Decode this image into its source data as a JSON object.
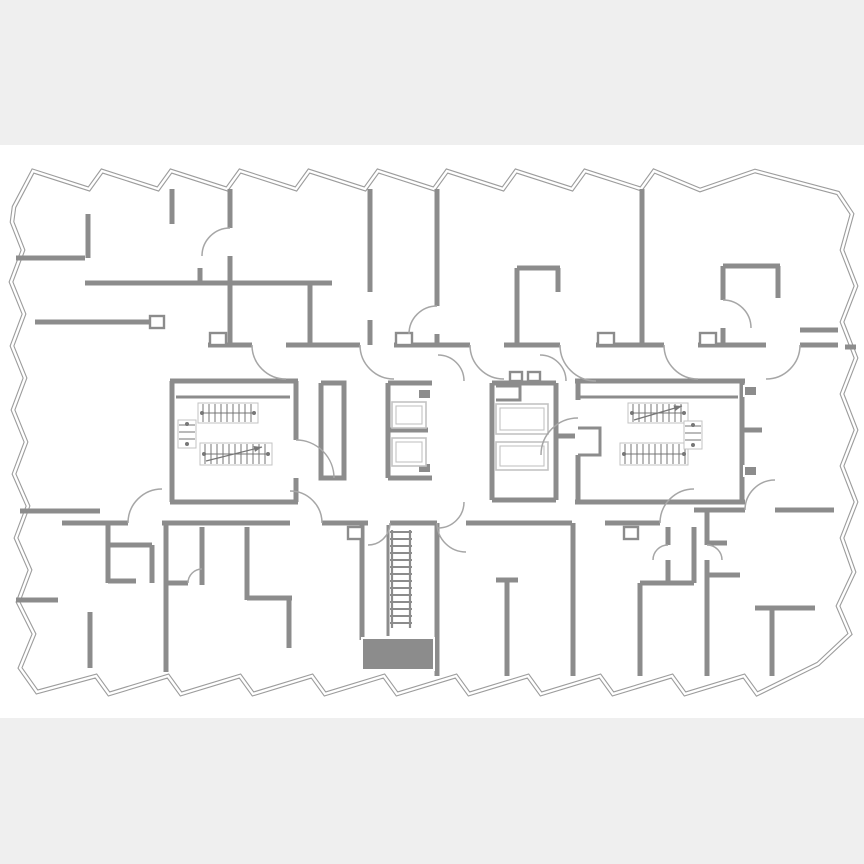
{
  "meta": {
    "kind": "architectural-floor-plan",
    "floor_text": ""
  },
  "colors": {
    "canvas_bg": "#efefef",
    "plan_bg": "#ffffff",
    "wall": "#8c8c8c",
    "outline": "#9c9c9c",
    "light": "#c3c3c3",
    "rail": "#777777",
    "arc": "#a6a6a6"
  },
  "plan": {
    "band": {
      "top": 145,
      "bottom": 718
    },
    "perimeter": [
      [
        14,
        207
      ],
      [
        33,
        171
      ],
      [
        89,
        189
      ],
      [
        102,
        171
      ],
      [
        158,
        189
      ],
      [
        171,
        171
      ],
      [
        227,
        189
      ],
      [
        240,
        171
      ],
      [
        296,
        189
      ],
      [
        309,
        171
      ],
      [
        365,
        189
      ],
      [
        378,
        171
      ],
      [
        434,
        189
      ],
      [
        447,
        171
      ],
      [
        503,
        189
      ],
      [
        516,
        171
      ],
      [
        572,
        189
      ],
      [
        585,
        171
      ],
      [
        641,
        189
      ],
      [
        654,
        171
      ],
      [
        700,
        190
      ],
      [
        755,
        171
      ],
      [
        838,
        193
      ],
      [
        852,
        214
      ],
      [
        842,
        250
      ],
      [
        856,
        286
      ],
      [
        842,
        322
      ],
      [
        856,
        358
      ],
      [
        842,
        394
      ],
      [
        856,
        430
      ],
      [
        842,
        466
      ],
      [
        856,
        502
      ],
      [
        842,
        538
      ],
      [
        854,
        572
      ],
      [
        838,
        606
      ],
      [
        850,
        634
      ],
      [
        818,
        664
      ],
      [
        757,
        694
      ],
      [
        744,
        676
      ],
      [
        685,
        694
      ],
      [
        672,
        676
      ],
      [
        613,
        694
      ],
      [
        600,
        676
      ],
      [
        541,
        694
      ],
      [
        528,
        676
      ],
      [
        469,
        694
      ],
      [
        456,
        676
      ],
      [
        397,
        694
      ],
      [
        384,
        676
      ],
      [
        325,
        694
      ],
      [
        312,
        676
      ],
      [
        253,
        694
      ],
      [
        240,
        676
      ],
      [
        181,
        694
      ],
      [
        168,
        676
      ],
      [
        109,
        694
      ],
      [
        96,
        676
      ],
      [
        37,
        692
      ],
      [
        20,
        668
      ],
      [
        34,
        634
      ],
      [
        18,
        602
      ],
      [
        30,
        570
      ],
      [
        16,
        538
      ],
      [
        28,
        506
      ],
      [
        14,
        474
      ],
      [
        26,
        442
      ],
      [
        13,
        410
      ],
      [
        25,
        378
      ],
      [
        12,
        346
      ],
      [
        24,
        314
      ],
      [
        11,
        282
      ],
      [
        23,
        250
      ],
      [
        12,
        222
      ]
    ],
    "walls": [
      [
        [
          16,
          258
        ],
        [
          85,
          258
        ]
      ],
      [
        [
          88,
          214
        ],
        [
          88,
          258
        ]
      ],
      [
        [
          85,
          283
        ],
        [
          332,
          283
        ]
      ],
      [
        [
          172,
          189
        ],
        [
          172,
          224
        ]
      ],
      [
        [
          200,
          268
        ],
        [
          200,
          283
        ]
      ],
      [
        [
          230,
          189
        ],
        [
          230,
          228
        ]
      ],
      [
        [
          230,
          256
        ],
        [
          230,
          345
        ]
      ],
      [
        [
          310,
          283
        ],
        [
          310,
          345
        ]
      ],
      [
        [
          370,
          189
        ],
        [
          370,
          292
        ]
      ],
      [
        [
          370,
          320
        ],
        [
          370,
          345
        ]
      ],
      [
        [
          437,
          189
        ],
        [
          437,
          306
        ]
      ],
      [
        [
          437,
          334
        ],
        [
          437,
          345
        ]
      ],
      [
        [
          517,
          268
        ],
        [
          517,
          345
        ]
      ],
      [
        [
          517,
          268
        ],
        [
          560,
          268
        ]
      ],
      [
        [
          558,
          268
        ],
        [
          558,
          292
        ]
      ],
      [
        [
          642,
          189
        ],
        [
          642,
          345
        ]
      ],
      [
        [
          723,
          266
        ],
        [
          723,
          300
        ]
      ],
      [
        [
          723,
          328
        ],
        [
          723,
          345
        ]
      ],
      [
        [
          723,
          266
        ],
        [
          780,
          266
        ]
      ],
      [
        [
          778,
          266
        ],
        [
          778,
          298
        ]
      ],
      [
        [
          800,
          330
        ],
        [
          838,
          330
        ]
      ],
      [
        [
          845,
          347
        ],
        [
          856,
          347
        ]
      ],
      [
        [
          35,
          322
        ],
        [
          152,
          322
        ]
      ],
      [
        [
          208,
          345
        ],
        [
          252,
          345
        ]
      ],
      [
        [
          286,
          345
        ],
        [
          360,
          345
        ]
      ],
      [
        [
          394,
          345
        ],
        [
          470,
          345
        ]
      ],
      [
        [
          504,
          345
        ],
        [
          560,
          345
        ]
      ],
      [
        [
          596,
          345
        ],
        [
          664,
          345
        ]
      ],
      [
        [
          698,
          345
        ],
        [
          766,
          345
        ]
      ],
      [
        [
          800,
          345
        ],
        [
          838,
          345
        ]
      ],
      [
        [
          170,
          381
        ],
        [
          298,
          381
        ]
      ],
      [
        [
          172,
          381
        ],
        [
          172,
          502
        ]
      ],
      [
        [
          170,
          502
        ],
        [
          298,
          502
        ]
      ],
      [
        [
          296,
          381
        ],
        [
          296,
          440
        ]
      ],
      [
        [
          296,
          478
        ],
        [
          296,
          502
        ]
      ],
      [
        [
          321,
          383
        ],
        [
          344,
          383
        ],
        [
          344,
          478
        ],
        [
          321,
          478
        ],
        [
          321,
          383
        ]
      ],
      [
        [
          388,
          383
        ],
        [
          388,
          478
        ]
      ],
      [
        [
          388,
          383
        ],
        [
          432,
          383
        ]
      ],
      [
        [
          388,
          430
        ],
        [
          428,
          430
        ]
      ],
      [
        [
          388,
          478
        ],
        [
          432,
          478
        ]
      ],
      [
        [
          492,
          383
        ],
        [
          492,
          500
        ]
      ],
      [
        [
          492,
          383
        ],
        [
          556,
          383
        ]
      ],
      [
        [
          556,
          383
        ],
        [
          556,
          500
        ]
      ],
      [
        [
          492,
          500
        ],
        [
          556,
          500
        ]
      ],
      [
        [
          556,
          436
        ],
        [
          575,
          436
        ]
      ],
      [
        [
          575,
          381
        ],
        [
          745,
          381
        ]
      ],
      [
        [
          742,
          381
        ],
        [
          742,
          502
        ]
      ],
      [
        [
          575,
          502
        ],
        [
          745,
          502
        ]
      ],
      [
        [
          578,
          381
        ],
        [
          578,
          400
        ]
      ],
      [
        [
          578,
          455
        ],
        [
          578,
          502
        ]
      ],
      [
        [
          742,
          430
        ],
        [
          762,
          430
        ]
      ],
      [
        [
          62,
          523
        ],
        [
          128,
          523
        ]
      ],
      [
        [
          162,
          523
        ],
        [
          290,
          523
        ]
      ],
      [
        [
          322,
          523
        ],
        [
          368,
          523
        ]
      ],
      [
        [
          390,
          523
        ],
        [
          437,
          523
        ]
      ],
      [
        [
          466,
          523
        ],
        [
          572,
          523
        ]
      ],
      [
        [
          605,
          523
        ],
        [
          660,
          523
        ]
      ],
      [
        [
          694,
          510
        ],
        [
          745,
          510
        ]
      ],
      [
        [
          775,
          510
        ],
        [
          834,
          510
        ]
      ],
      [
        [
          20,
          511
        ],
        [
          100,
          511
        ]
      ],
      [
        [
          108,
          523
        ],
        [
          108,
          583
        ]
      ],
      [
        [
          108,
          545
        ],
        [
          152,
          545
        ]
      ],
      [
        [
          152,
          545
        ],
        [
          152,
          583
        ]
      ],
      [
        [
          108,
          581
        ],
        [
          136,
          581
        ]
      ],
      [
        [
          166,
          523
        ],
        [
          166,
          672
        ]
      ],
      [
        [
          202,
          527
        ],
        [
          202,
          585
        ]
      ],
      [
        [
          166,
          583
        ],
        [
          188,
          583
        ]
      ],
      [
        [
          247,
          527
        ],
        [
          247,
          600
        ]
      ],
      [
        [
          247,
          598
        ],
        [
          292,
          598
        ]
      ],
      [
        [
          289,
          598
        ],
        [
          289,
          648
        ]
      ],
      [
        [
          16,
          600
        ],
        [
          58,
          600
        ]
      ],
      [
        [
          90,
          612
        ],
        [
          90,
          668
        ]
      ],
      [
        [
          362,
          523
        ],
        [
          362,
          640
        ]
      ],
      [
        [
          437,
          523
        ],
        [
          437,
          676
        ]
      ],
      [
        [
          507,
          580
        ],
        [
          507,
          676
        ]
      ],
      [
        [
          496,
          580
        ],
        [
          518,
          580
        ]
      ],
      [
        [
          573,
          523
        ],
        [
          573,
          676
        ]
      ],
      [
        [
          640,
          583
        ],
        [
          640,
          676
        ]
      ],
      [
        [
          640,
          583
        ],
        [
          694,
          583
        ]
      ],
      [
        [
          668,
          527
        ],
        [
          668,
          545
        ]
      ],
      [
        [
          668,
          560
        ],
        [
          668,
          583
        ]
      ],
      [
        [
          694,
          527
        ],
        [
          694,
          583
        ]
      ],
      [
        [
          707,
          510
        ],
        [
          707,
          545
        ]
      ],
      [
        [
          707,
          560
        ],
        [
          707,
          676
        ]
      ],
      [
        [
          707,
          543
        ],
        [
          727,
          543
        ]
      ],
      [
        [
          707,
          575
        ],
        [
          740,
          575
        ]
      ],
      [
        [
          755,
          608
        ],
        [
          815,
          608
        ]
      ],
      [
        [
          772,
          608
        ],
        [
          772,
          676
        ]
      ]
    ],
    "thin_walls": [
      [
        [
          176,
          397
        ],
        [
          290,
          397
        ]
      ],
      [
        [
          580,
          397
        ],
        [
          738,
          397
        ]
      ],
      [
        [
          496,
          386
        ],
        [
          520,
          386
        ],
        [
          520,
          400
        ],
        [
          496,
          400
        ]
      ],
      [
        [
          578,
          428
        ],
        [
          600,
          428
        ],
        [
          600,
          455
        ],
        [
          578,
          455
        ]
      ],
      [
        [
          388,
          525
        ],
        [
          388,
          636
        ]
      ]
    ],
    "blocks": [
      {
        "x": 362,
        "y": 638,
        "w": 72,
        "h": 32
      },
      {
        "x": 418,
        "y": 389,
        "w": 13,
        "h": 10
      },
      {
        "x": 418,
        "y": 463,
        "w": 13,
        "h": 10
      },
      {
        "x": 744,
        "y": 386,
        "w": 13,
        "h": 10
      },
      {
        "x": 744,
        "y": 466,
        "w": 13,
        "h": 10
      }
    ],
    "thresholds": [
      {
        "x": 210,
        "y": 333,
        "w": 16,
        "h": 12
      },
      {
        "x": 396,
        "y": 333,
        "w": 16,
        "h": 12
      },
      {
        "x": 598,
        "y": 333,
        "w": 16,
        "h": 12
      },
      {
        "x": 700,
        "y": 333,
        "w": 16,
        "h": 12
      },
      {
        "x": 510,
        "y": 372,
        "w": 12,
        "h": 9
      },
      {
        "x": 528,
        "y": 372,
        "w": 12,
        "h": 9
      },
      {
        "x": 348,
        "y": 527,
        "w": 14,
        "h": 12
      },
      {
        "x": 624,
        "y": 527,
        "w": 14,
        "h": 12
      },
      {
        "x": 150,
        "y": 316,
        "w": 14,
        "h": 12
      }
    ],
    "stairs": [
      {
        "x": 198,
        "y": 403,
        "w": 60,
        "h": 20
      },
      {
        "x": 200,
        "y": 443,
        "w": 72,
        "h": 22,
        "arrow": [
          [
            206,
            461
          ],
          [
            262,
            447
          ]
        ]
      },
      {
        "x": 628,
        "y": 403,
        "w": 60,
        "h": 20,
        "arrow": [
          [
            634,
            420
          ],
          [
            682,
            406
          ]
        ]
      },
      {
        "x": 620,
        "y": 443,
        "w": 68,
        "h": 22
      }
    ],
    "winders": [
      {
        "x": 178,
        "y": 420,
        "w": 18,
        "h": 28
      },
      {
        "x": 684,
        "y": 421,
        "w": 18,
        "h": 28
      }
    ],
    "elevators": [
      {
        "x": 392,
        "y": 402,
        "w": 34,
        "h": 26
      },
      {
        "x": 392,
        "y": 438,
        "w": 34,
        "h": 28
      },
      {
        "x": 496,
        "y": 404,
        "w": 52,
        "h": 30
      },
      {
        "x": 496,
        "y": 442,
        "w": 52,
        "h": 28
      }
    ],
    "ladder": {
      "x1": 392,
      "x2": 410,
      "y1": 530,
      "y2": 628,
      "step": 7
    },
    "arcs": [
      "M252 345 A34 34 0 0 0 286 379",
      "M360 345 A34 34 0 0 0 394 379",
      "M470 345 A34 34 0 0 0 504 379",
      "M560 345 A36 36 0 0 0 596 381",
      "M664 345 A34 34 0 0 0 698 379",
      "M800 345 A34 34 0 0 1 766 379",
      "M230 228 A28 28 0 0 0 202 256",
      "M437 306 A28 28 0 0 0 409 334",
      "M723 300 A28 28 0 0 1 751 328",
      "M296 440 A38 38 0 0 1 334 478",
      "M578 418 A37 37 0 0 0 541 455",
      "M464 381 A26 26 0 0 0 438 355",
      "M566 381 A26 26 0 0 0 540 355",
      "M464 502 A26 26 0 0 1 438 528",
      "M128 523 A34 34 0 0 1 162 489",
      "M322 523 A32 32 0 0 0 290 491",
      "M437 523 A29 29 0 0 0 466 552",
      "M660 523 A34 34 0 0 1 694 489",
      "M745 510 A30 30 0 0 1 775 480",
      "M390 523 A22 22 0 0 1 368 545",
      "M188 583 A14 14 0 0 1 202 569",
      "M668 545 A15 15 0 0 0 653 560",
      "M707 545 A15 15 0 0 1 722 560"
    ]
  }
}
